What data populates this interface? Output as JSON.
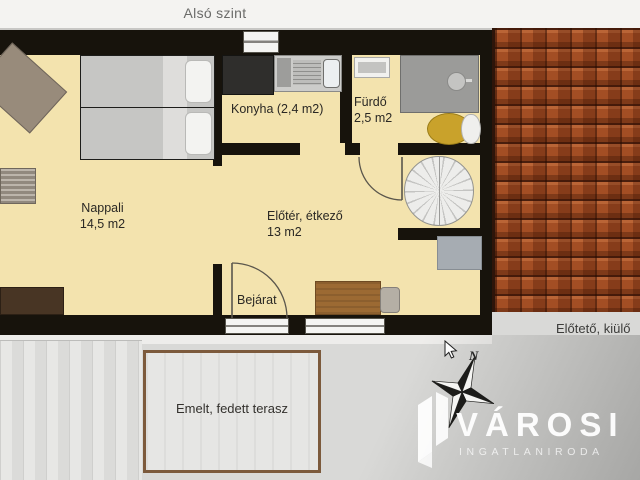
{
  "title": "Alsó szint",
  "plan": {
    "rooms": {
      "nappali": {
        "name": "Nappali",
        "area": "14,5 m2"
      },
      "konyha": {
        "label": "Konyha (2,4 m2)"
      },
      "furdo": {
        "name": "Fürdő",
        "area": "2,5 m2"
      },
      "eloter": {
        "name": "Előtér, étkező",
        "area": "13 m2"
      }
    },
    "entrance_label": "Bejárat",
    "terrace_label": "Emelt, fedett terasz",
    "canopy_label": "Előtető, kiülő"
  },
  "compass": {
    "north_label": "N"
  },
  "watermark": {
    "brand": "VÁROSI",
    "subtitle": "INGATLANIRODA"
  },
  "colors": {
    "floor": "#f3e3ae",
    "wall": "#17130c",
    "roof": "#a34e24",
    "terrace_border": "#7c5a3c",
    "label": "#2a2824"
  }
}
